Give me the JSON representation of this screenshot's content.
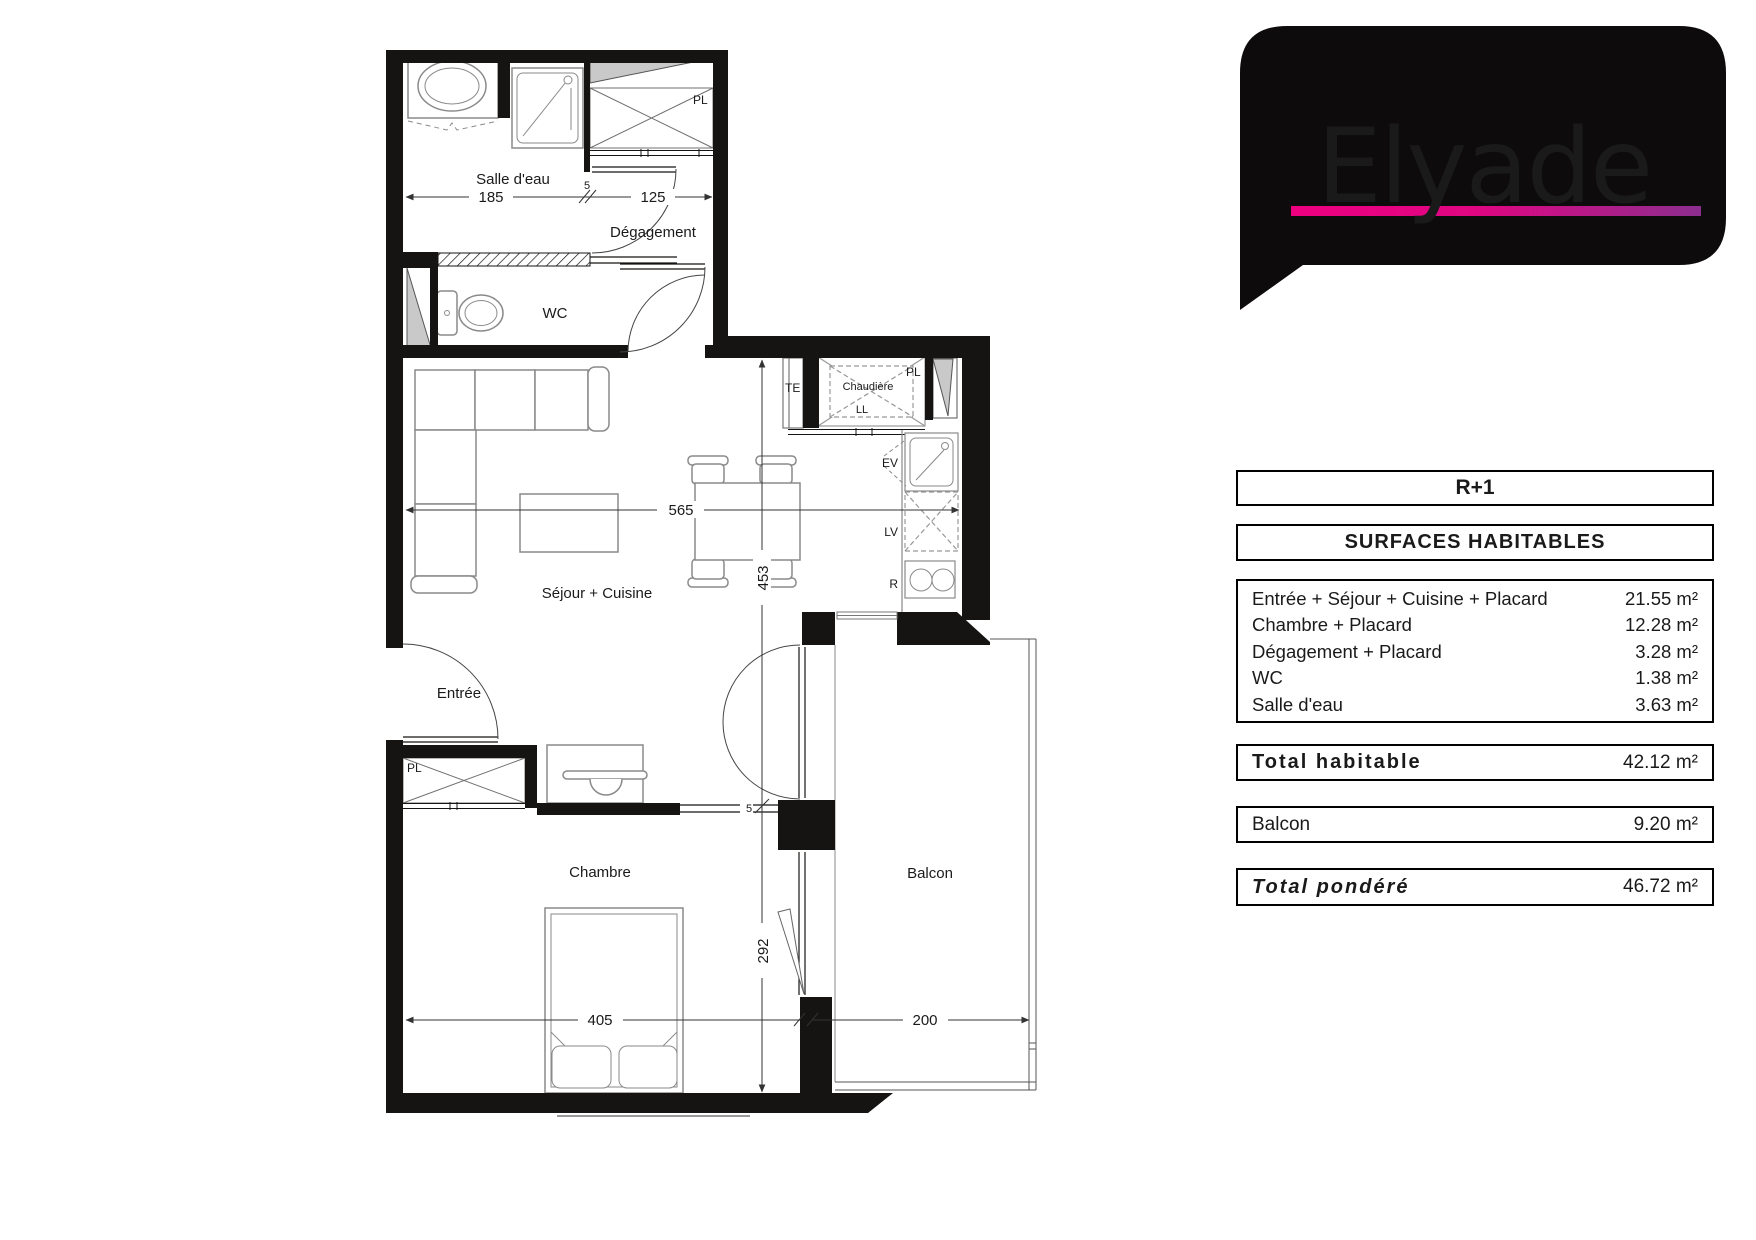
{
  "logo": {
    "brand": "Elyade",
    "bubble_color": "#0d0b0c",
    "accent_start": "#ec0080",
    "accent_end": "#8c2e8e"
  },
  "panel": {
    "level": "R+1",
    "header": "SURFACES HABITABLES",
    "rows": [
      {
        "label": "Entrée + Séjour + Cuisine + Placard",
        "value": "21.55 m²"
      },
      {
        "label": "Chambre + Placard",
        "value": "12.28 m²"
      },
      {
        "label": "Dégagement + Placard",
        "value": "3.28 m²"
      },
      {
        "label": "WC",
        "value": "1.38 m²"
      },
      {
        "label": "Salle d'eau",
        "value": "3.63 m²"
      }
    ],
    "total_habitable": {
      "label": "Total habitable",
      "value": "42.12 m²"
    },
    "balcon": {
      "label": "Balcon",
      "value": "9.20 m²"
    },
    "total_pondere": {
      "label": "Total pondéré",
      "value": "46.72 m²"
    }
  },
  "plan": {
    "rooms": {
      "salle_deau": "Salle d'eau",
      "degagement": "Dégagement",
      "wc": "WC",
      "sejour": "Séjour + Cuisine",
      "entree": "Entrée",
      "chambre": "Chambre",
      "balcon": "Balcon"
    },
    "fixtures": {
      "pl_top": "PL",
      "pl_kitchen": "PL",
      "pl_entree": "PL",
      "te": "TE",
      "chaudiere": "Chaudière",
      "ll": "LL",
      "ev": "EV",
      "lv": "LV",
      "r": "R"
    },
    "dims": {
      "d185": "185",
      "d5a": "5",
      "d125": "125",
      "d565": "565",
      "d453": "453",
      "d405": "405",
      "d292": "292",
      "d200": "200",
      "d5b": "5"
    }
  }
}
